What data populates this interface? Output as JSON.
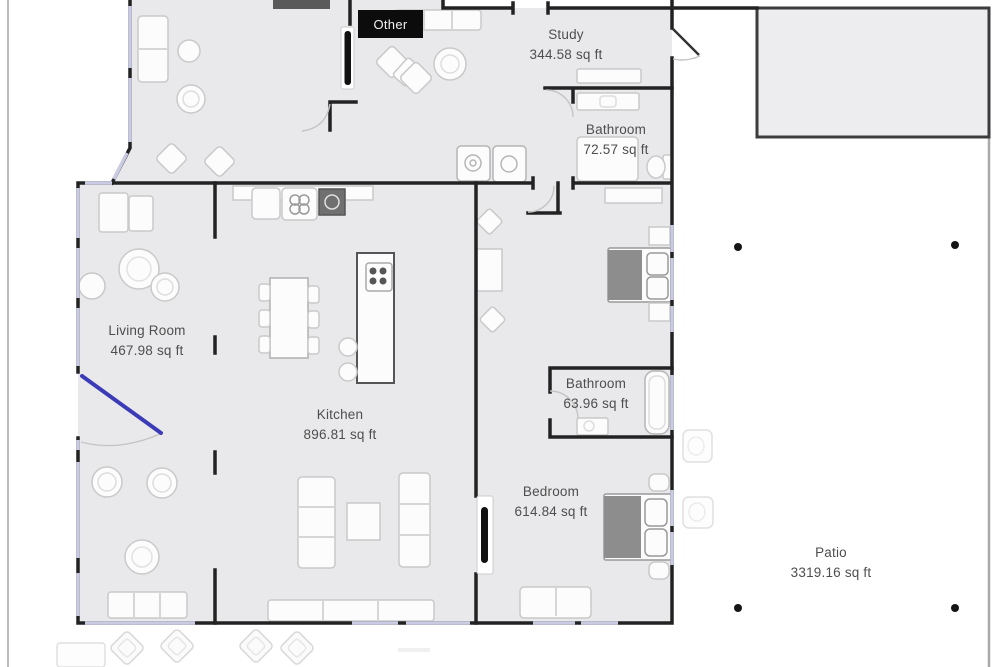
{
  "app": {
    "view": "floor-plan"
  },
  "labels": {
    "other": "Other",
    "rooms": [
      {
        "key": "study",
        "name": "Study",
        "area": "344.58 sq ft"
      },
      {
        "key": "bathroom-upper",
        "name": "Bathroom",
        "area": "72.57 sq ft"
      },
      {
        "key": "living-room",
        "name": "Living Room",
        "area": "467.98 sq ft"
      },
      {
        "key": "kitchen",
        "name": "Kitchen",
        "area": "896.81 sq ft"
      },
      {
        "key": "bathroom-lower",
        "name": "Bathroom",
        "area": "63.96 sq ft"
      },
      {
        "key": "bedroom",
        "name": "Bedroom",
        "area": "614.84 sq ft"
      },
      {
        "key": "patio",
        "name": "Patio",
        "area": "3319.16 sq ft"
      }
    ]
  },
  "colors": {
    "wall": "#222222",
    "floor": "#e9e9eb",
    "window": "#c9cbe3",
    "door_accent": "#3b3bb8",
    "bed_blanket": "#8d8d8d",
    "label_text": "#4e4e4e",
    "other_badge_bg": "#0c0c0c",
    "patio_post": "#151515",
    "annex_fill": "#ededef"
  }
}
